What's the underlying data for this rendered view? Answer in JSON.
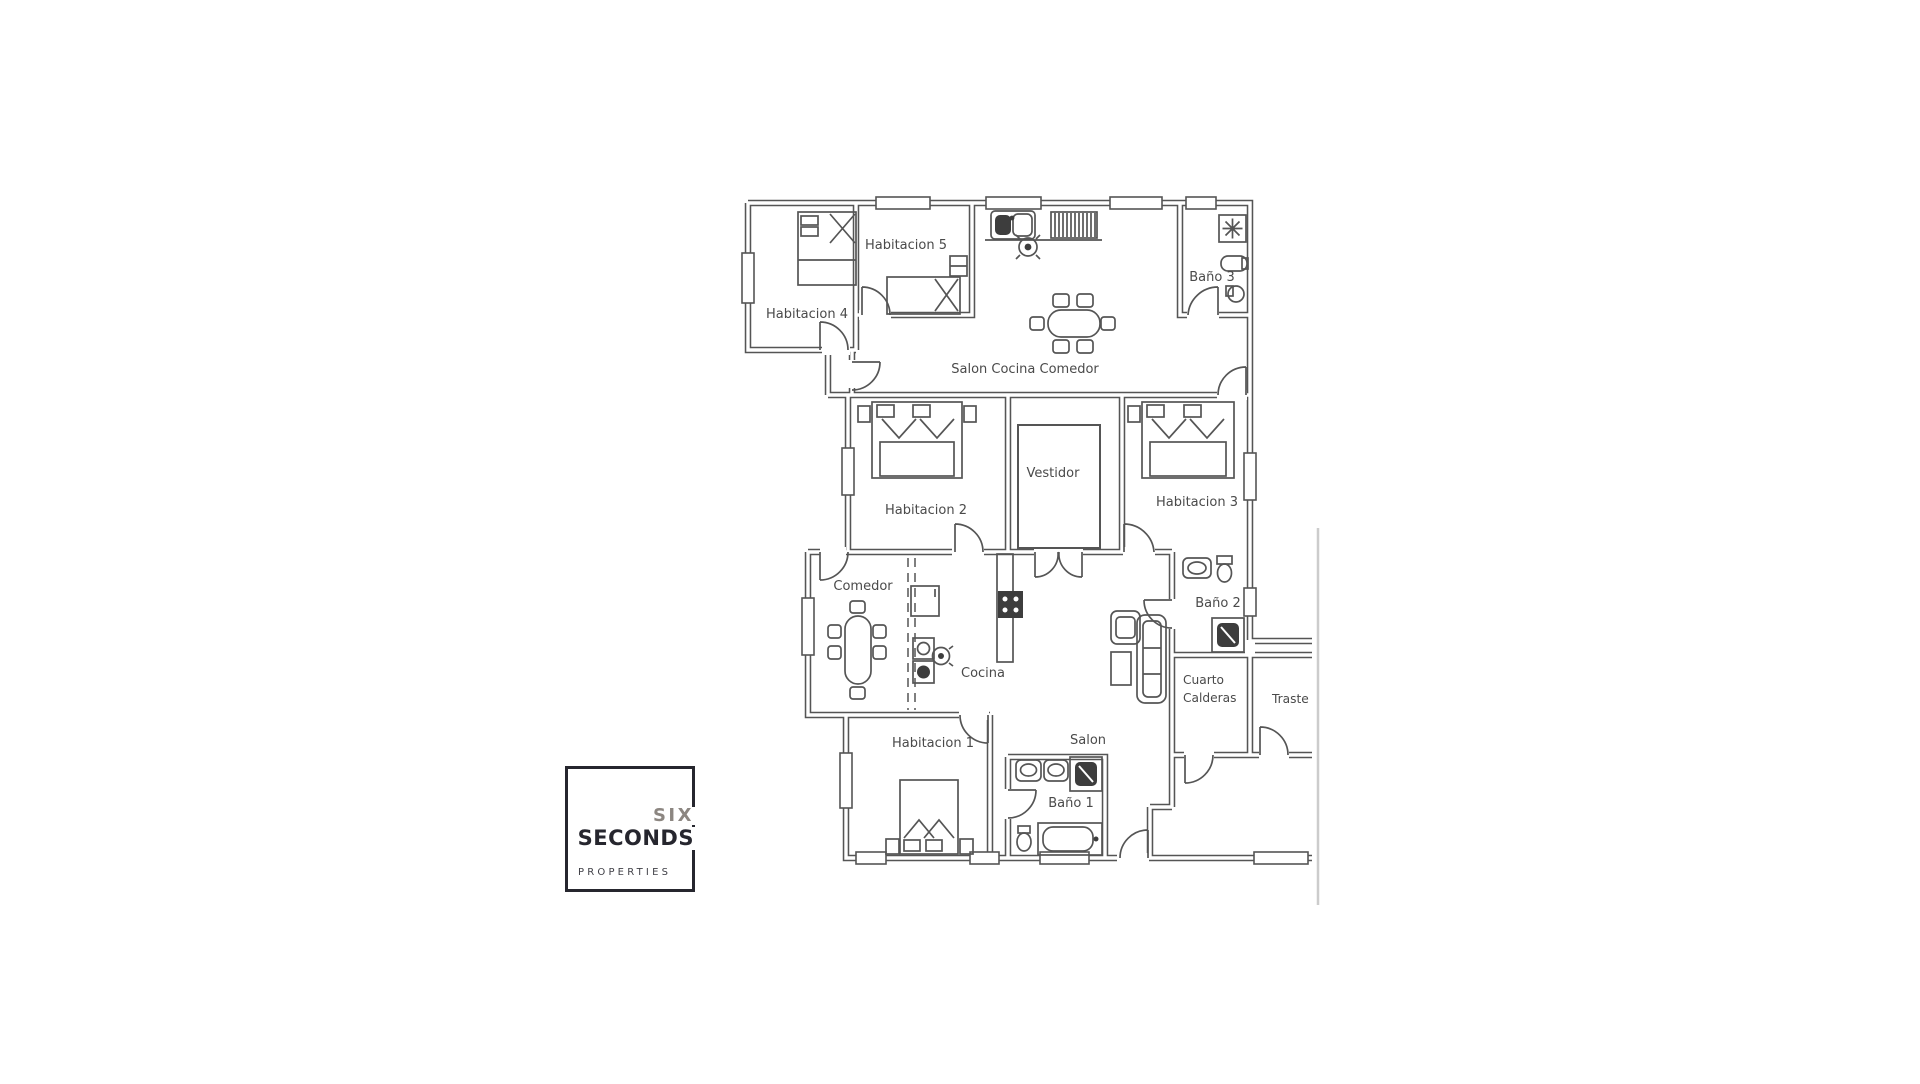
{
  "floorplan": {
    "wall_color": "#555555",
    "label_color": "#4a4a4a",
    "fixture_fill": "#3d3d3d",
    "scan_edge_color": "#cccccc",
    "rooms": {
      "habitacion_1": "Habitacion 1",
      "habitacion_2": "Habitacion 2",
      "habitacion_3": "Habitacion 3",
      "habitacion_4": "Habitacion 4",
      "habitacion_5": "Habitacion 5",
      "salon_cocina_comedor": "Salon Cocina Comedor",
      "vestidor": "Vestidor",
      "comedor": "Comedor",
      "cocina": "Cocina",
      "salon": "Salon",
      "bano_1": "Baño 1",
      "bano_2": "Baño 2",
      "bano_3": "Baño 3",
      "cuarto_calderas_line1": "Cuarto",
      "cuarto_calderas_line2": "Calderas",
      "trastero_cut": "Traste"
    }
  },
  "logo": {
    "word_top": "SIX",
    "word_main": "SECONDS",
    "word_sub": "PROPERTIES",
    "accent_color": "#8c8681",
    "ink_color": "#26262e"
  }
}
